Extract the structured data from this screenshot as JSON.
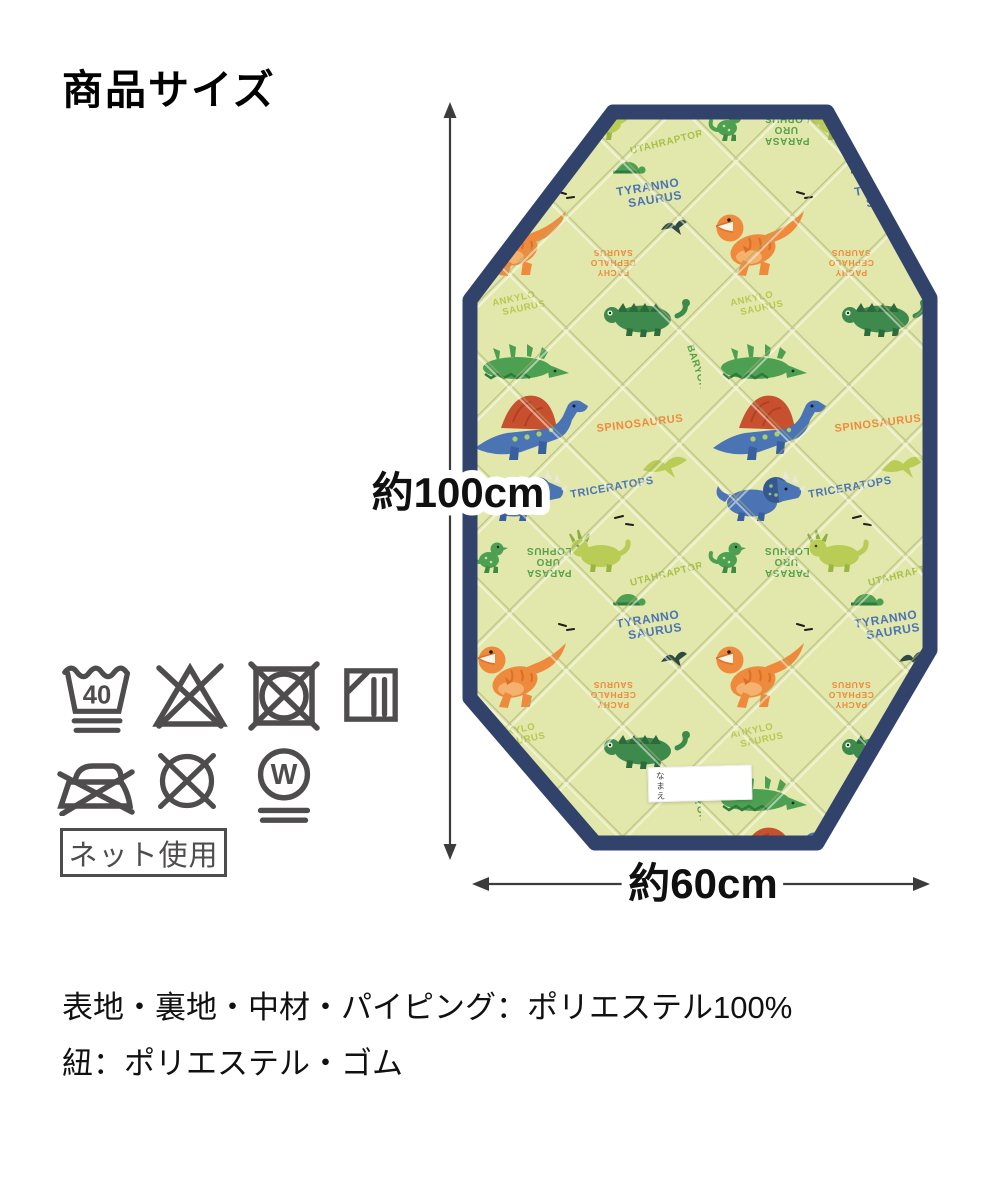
{
  "title": "商品サイズ",
  "dimensions": {
    "height": "約100cm",
    "width": "約60cm"
  },
  "care": {
    "wash_temp": "40",
    "wet_clean": "W",
    "note": "ネット使用",
    "symbols": [
      "wash-40-very-gentle",
      "no-bleach",
      "no-tumble-dry",
      "dry-in-shade",
      "no-iron",
      "no-dry-clean",
      "wet-clean-very-gentle"
    ]
  },
  "materials": {
    "line1": "表地・裏地・中材・パイピング：ポリエステル100%",
    "line2": "紐：ポリエステル・ゴム"
  },
  "mat": {
    "name_tag": "なまえ",
    "colors": {
      "base": "#e2e7ab",
      "piping": "#31436b",
      "orange": "#ef8a3c",
      "blue": "#4a74b4",
      "green": "#4da052",
      "dark_green": "#3e8a4d",
      "light_green": "#b9cc55",
      "sail_red": "#c7502f"
    },
    "pattern_text": {
      "tyranno_1": "TYRANNO",
      "tyranno_2": "SAURUS",
      "triceratops": "TRICERATOPS",
      "spinosaurus": "SPINOSAURUS",
      "baryonyx": "BARYONYX",
      "utahraptor": "UTAHRAPTOR",
      "parasa_1": "PARASA",
      "parasa_2": "URO",
      "parasa_3": "LOPHUS",
      "ankylo_1": "ANKYLO",
      "ankylo_2": "SAURUS",
      "pachy_1": "PACHY",
      "pachy_2": "CEPHALO",
      "pachy_3": "SAURUS"
    }
  }
}
